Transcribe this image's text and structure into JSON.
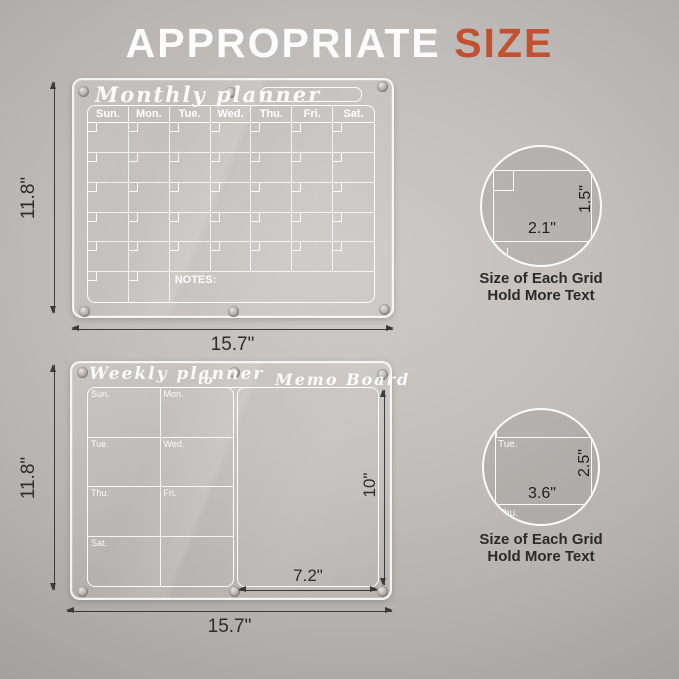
{
  "title": {
    "word1": "APPROPRIATE",
    "word2": "SIZE",
    "accent_color": "#c2522f"
  },
  "monthly": {
    "board_title": "Monthly planner",
    "day_headers": [
      "Sun.",
      "Mon.",
      "Tue.",
      "Wed.",
      "Thu.",
      "Fri.",
      "Sat."
    ],
    "notes_label": "NOTES:",
    "width_label": "15.7\"",
    "height_label": "11.8\""
  },
  "weekly": {
    "board_title": "Weekly planner",
    "range_separator": "to",
    "memo_title": "Memo Board",
    "day_cells": [
      "Sun.",
      "Mon.",
      "Tue.",
      "Wed.",
      "Thu.",
      "Fri.",
      "Sat.",
      ""
    ],
    "memo_width_label": "7.2\"",
    "memo_height_label": "10\"",
    "width_label": "15.7\"",
    "height_label": "11.8\""
  },
  "detail_monthly": {
    "cell_width_label": "2.1\"",
    "cell_height_label": "1.5\"",
    "caption_line1": "Size of Each Grid",
    "caption_line2": "Hold More Text"
  },
  "detail_weekly": {
    "cell_width_label": "3.6\"",
    "cell_height_label": "2.5\"",
    "cell_day_label": "Tue.",
    "cell_day_label_right": "We",
    "cell_day_label_below": "Thu.",
    "caption_line1": "Size of Each Grid",
    "caption_line2": "Hold More Text"
  }
}
